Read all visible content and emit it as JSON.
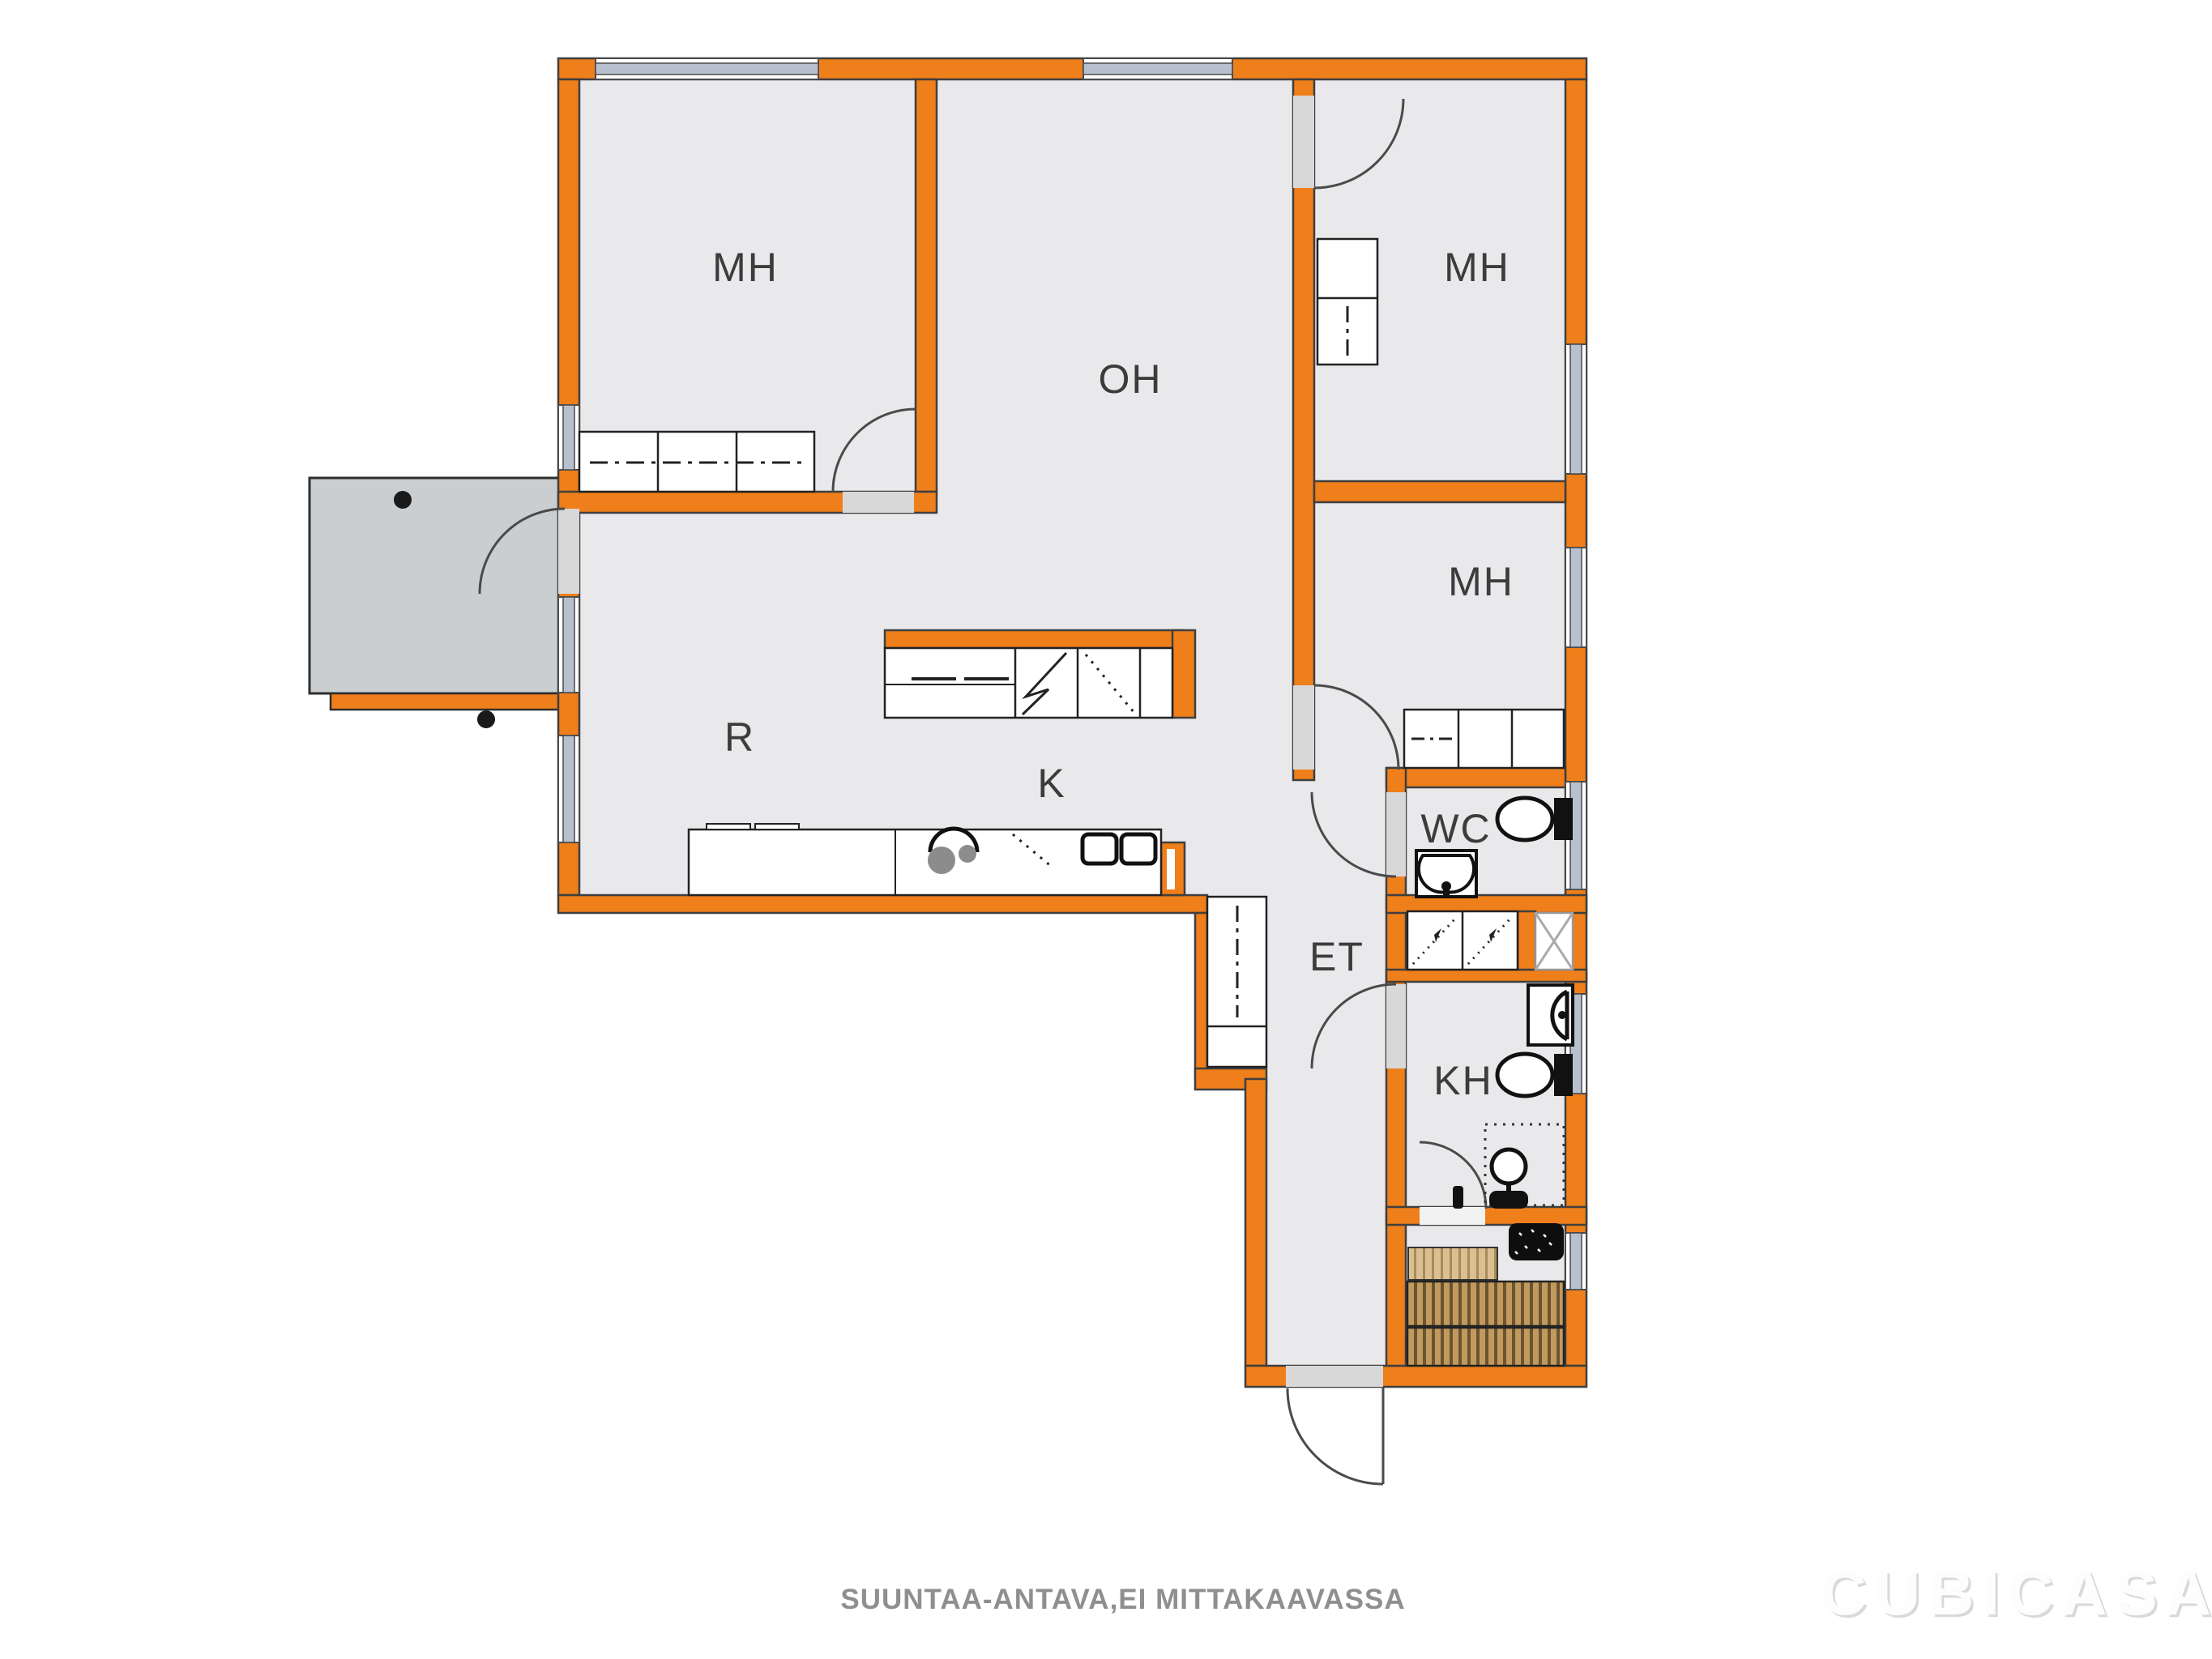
{
  "meta": {
    "type": "floor-plan",
    "vendor_watermark": "CubiCasa"
  },
  "labels": {
    "mh_top_left": "MH",
    "oh": "OH",
    "mh_top_right": "MH",
    "mh_mid_right": "MH",
    "r": "R",
    "k": "K",
    "wc": "WC",
    "et": "ET",
    "kh": "KH"
  },
  "footer": {
    "disclaimer": "SUUNTAA-ANTAVA,EI MITTAKAAVASSA"
  },
  "watermark": {
    "brand": "CUBICASA"
  },
  "colors": {
    "wall": "#EF7F1A",
    "wall_outline": "#3F3F3F",
    "floor": "#E9E9EC",
    "terrace": "#CBCED1",
    "door_opening": "#D8D8D8",
    "window_glass": "#B7C0CE",
    "bench_wood": "#C39A5E",
    "bench_wood_light": "#D9BF92",
    "fixture_outline": "#111111",
    "label_text": "#3C3C3C",
    "footer_text": "#8F8F8F"
  },
  "fixture_icons": [
    "toilet-icon",
    "sink-icon",
    "shower-mixer-icon",
    "shower-basin-icon",
    "sauna-stove-icon",
    "sauna-bench-icon",
    "wardrobe-icon",
    "sliding-wardrobe-icon",
    "fridge-icon",
    "freezer-icon",
    "dishwasher-icon",
    "kitchen-sink-icon",
    "cooktop-icon",
    "ventilation-shaft-icon",
    "door-swing-icon",
    "window-icon"
  ]
}
